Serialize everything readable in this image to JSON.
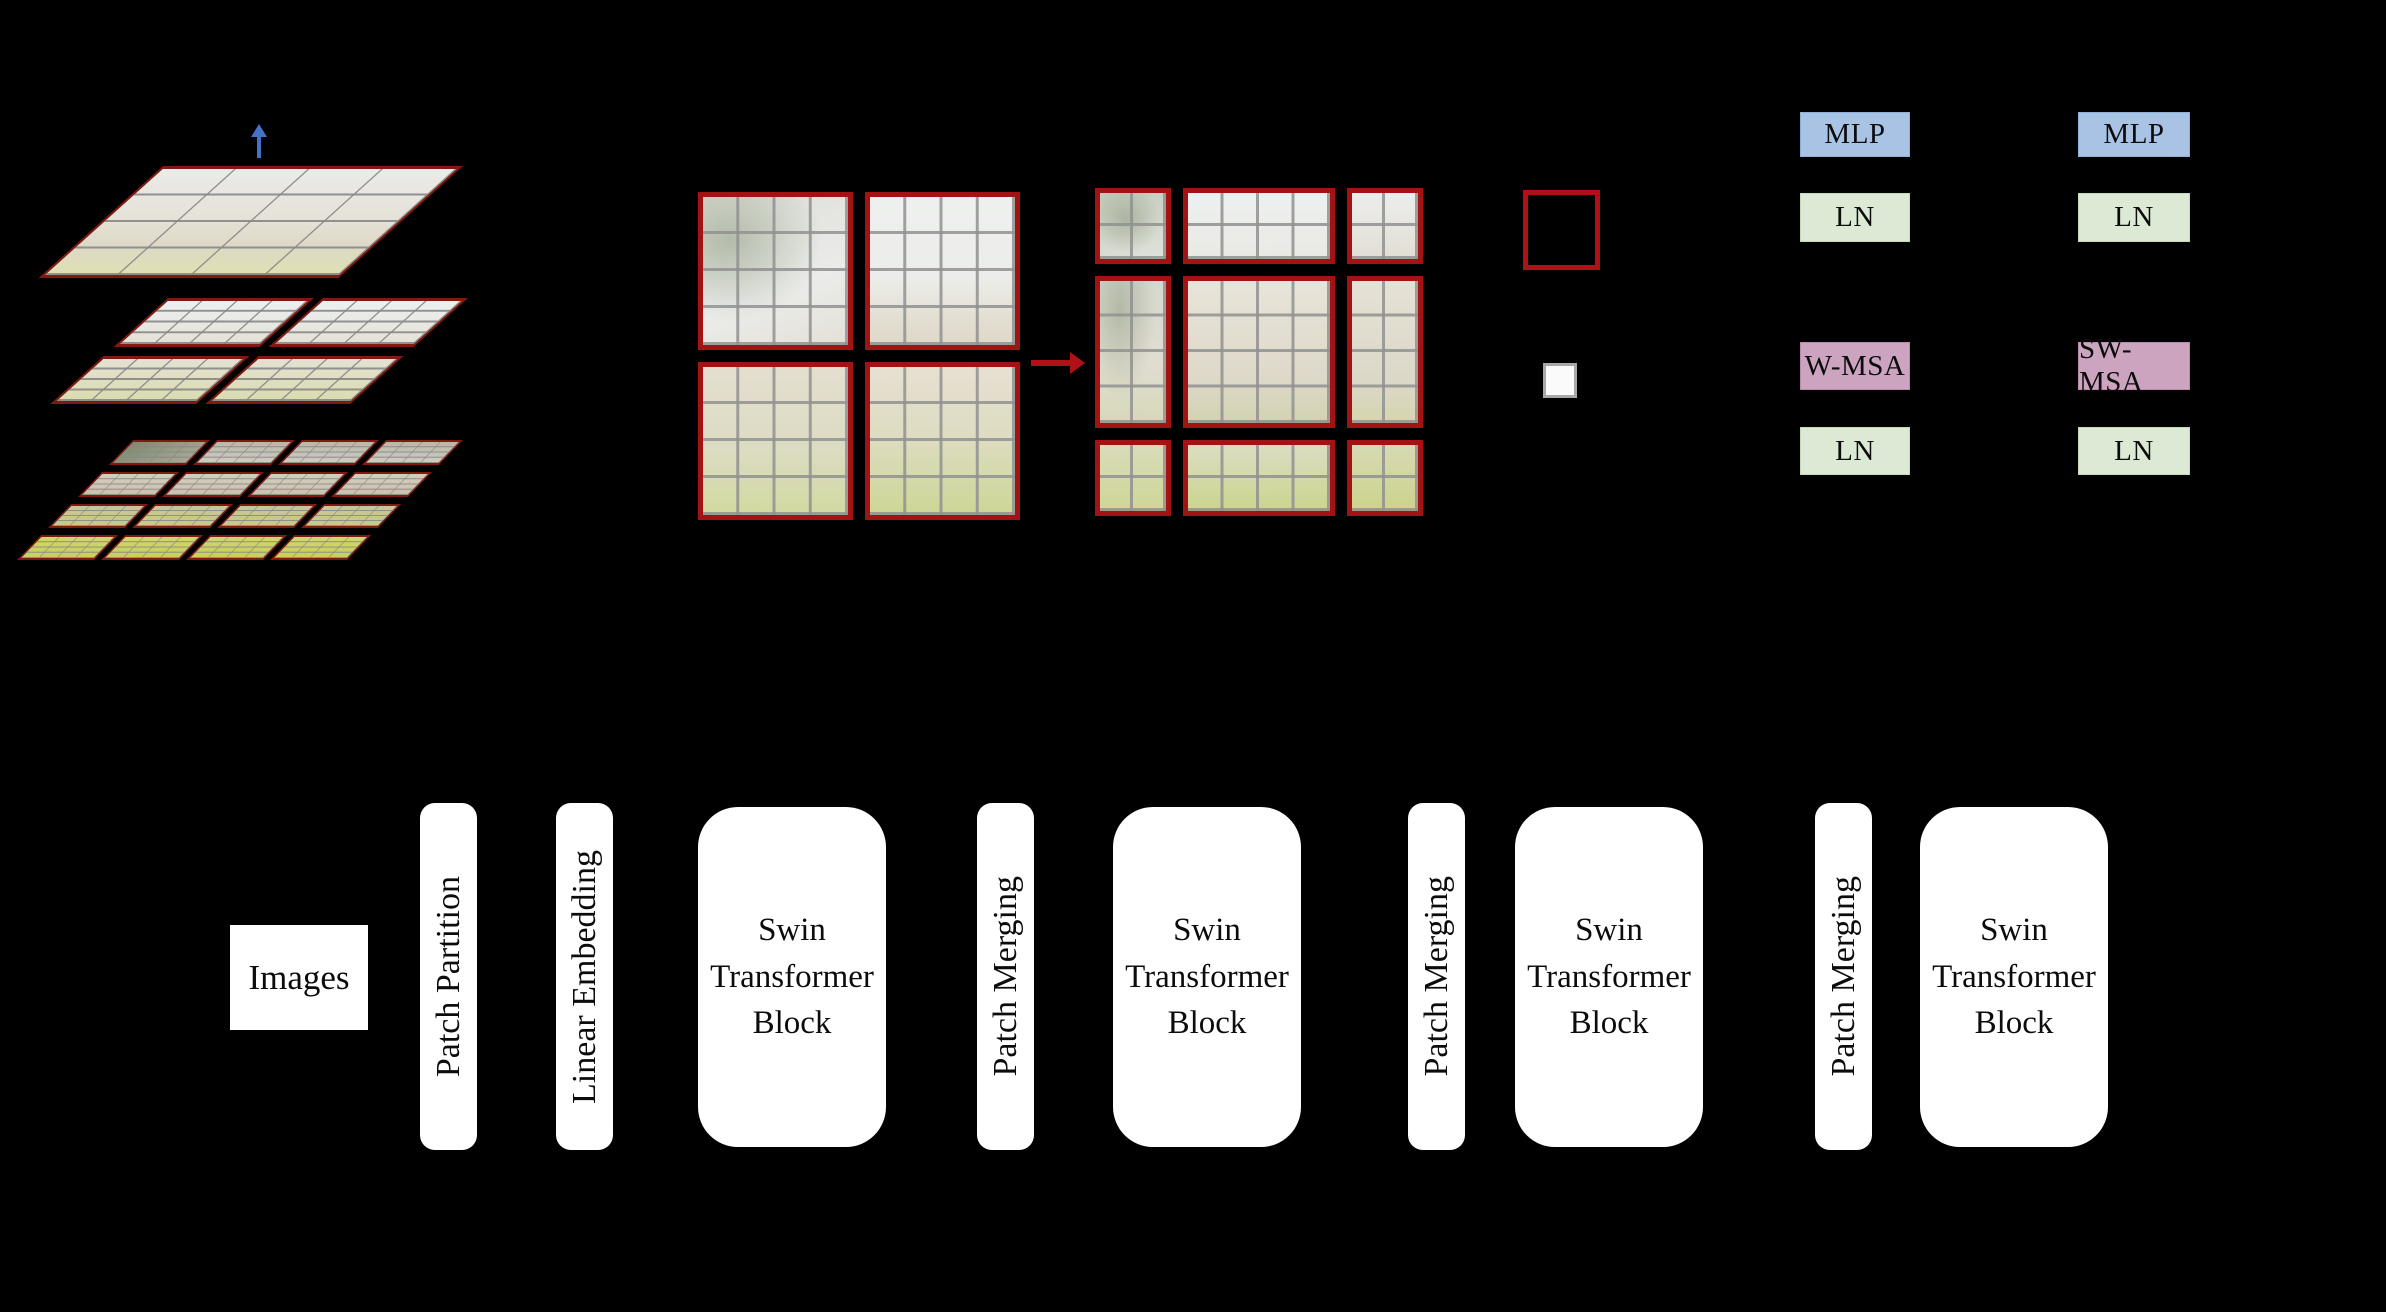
{
  "diagram": {
    "hierarchy": {
      "layer_count": 3,
      "up_arrow_icon": "up-arrow",
      "plane_border_color": "#80190f"
    },
    "window_partition": {
      "left_window_count": 4,
      "right_window_count": 9,
      "shift_arrow_icon": "right-arrow",
      "window_border_color": "#a31313"
    },
    "legend": {
      "window_marker_color": "#b01116",
      "patch_marker_fill": "#fafafa",
      "patch_marker_border": "#a8a8a8"
    },
    "block_diagram": {
      "left_column": [
        "MLP",
        "LN",
        "W-MSA",
        "LN"
      ],
      "right_column": [
        "MLP",
        "LN",
        "SW-MSA",
        "LN"
      ],
      "mlp_color": "#a9c3e4",
      "ln_color": "#dcead5",
      "msa_color": "#cda4c0"
    },
    "pipeline": {
      "input_label": "Images",
      "stages": [
        {
          "kind": "thin",
          "label": "Patch Partition"
        },
        {
          "kind": "thin",
          "label": "Linear Embedding"
        },
        {
          "kind": "block",
          "label": "Swin Transformer Block"
        },
        {
          "kind": "thin",
          "label": "Patch Merging"
        },
        {
          "kind": "block",
          "label": "Swin Transformer Block"
        },
        {
          "kind": "thin",
          "label": "Patch Merging"
        },
        {
          "kind": "block",
          "label": "Swin Transformer Block"
        },
        {
          "kind": "thin",
          "label": "Patch Merging"
        },
        {
          "kind": "block",
          "label": "Swin Transformer Block"
        }
      ],
      "box_fill": "#ffffff"
    },
    "colors": {
      "background": "#000000",
      "arrow_red": "#b01116",
      "arrow_blue": "#4472c4",
      "grid_line_gray": "#878787"
    }
  }
}
